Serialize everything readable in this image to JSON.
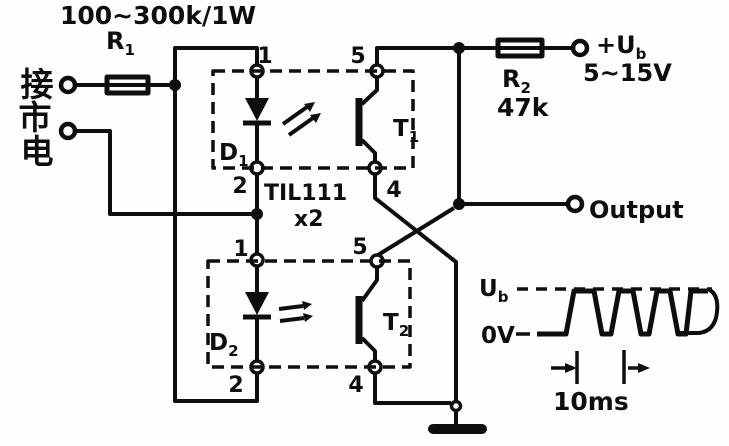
{
  "figure": {
    "background": "#fffefd",
    "ink": "#0e0e0e",
    "mains": {
      "chars": [
        "接",
        "市",
        "电"
      ]
    },
    "r1": {
      "ref_base": "R",
      "ref_sub": "1",
      "value": "100~300k/1W"
    },
    "r2": {
      "ref_base": "R",
      "ref_sub": "2",
      "value": "47k"
    },
    "supply": {
      "label_base": "+U",
      "label_sub": "b",
      "range": "5~15V"
    },
    "ic": {
      "part": "TIL111",
      "qty": "x2"
    },
    "opto1": {
      "led_base": "D",
      "led_sub": "1",
      "tr_base": "T",
      "tr_sub": "1",
      "pin1": "1",
      "pin2": "2",
      "pin5": "5",
      "pin4": "4"
    },
    "opto2": {
      "led_base": "D",
      "led_sub": "2",
      "tr_base": "T",
      "tr_sub": "2",
      "pin1": "1",
      "pin2": "2",
      "pin5": "5",
      "pin4": "4"
    },
    "output_label": "Output",
    "wave": {
      "high_base": "U",
      "high_sub": "b",
      "low": "0V",
      "period": "10ms"
    }
  }
}
